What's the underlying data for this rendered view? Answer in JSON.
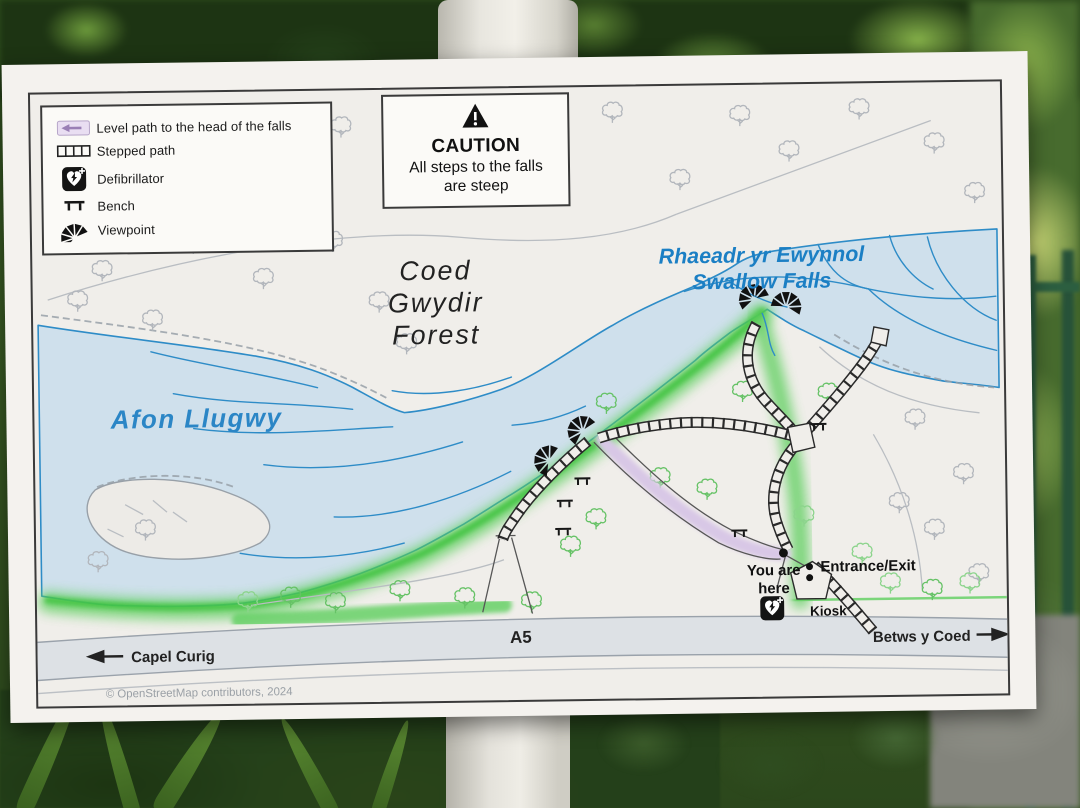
{
  "sign": {
    "legend": {
      "items": [
        {
          "icon": "level-path-icon",
          "label": "Level path to the head of the falls"
        },
        {
          "icon": "stepped-path-icon",
          "label": "Stepped path"
        },
        {
          "icon": "defibrillator-icon",
          "label": "Defibrillator"
        },
        {
          "icon": "bench-icon",
          "label": "Bench"
        },
        {
          "icon": "viewpoint-icon",
          "label": "Viewpoint"
        }
      ]
    },
    "caution": {
      "title": "CAUTION",
      "line1": "All steps to the falls",
      "line2": "are steep"
    },
    "map": {
      "forest1": "Coed",
      "forest2": "Gwydir",
      "forest3": "Forest",
      "river": "Afon Llugwy",
      "falls1": "Rhaeadr yr Ewynnol",
      "falls2": "Swallow Falls",
      "yah1": "You are",
      "yah2": "here",
      "entrance": "Entrance/Exit",
      "kiosk": "Kiosk",
      "a5": "A5",
      "west": "Capel Curig",
      "east": "Betws y Coed"
    },
    "credit": "© OpenStreetMap contributors, 2024",
    "colors": {
      "water": "#cfe0ec",
      "water_line": "#2e8cc7",
      "green_bank": "#5ecf5e",
      "level_path": "#d8c7e6",
      "road": "#dde1e5",
      "label_blue": "#1b7fc4",
      "paper": "#f0eeea"
    }
  }
}
